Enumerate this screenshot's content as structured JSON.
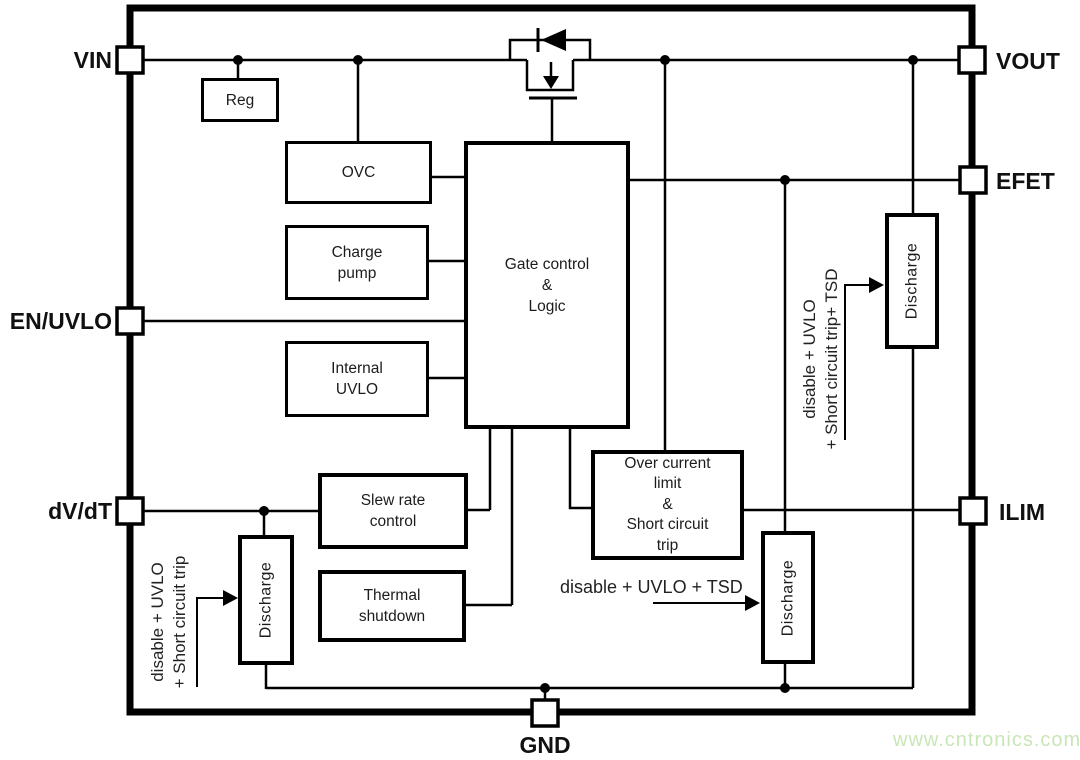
{
  "diagram": {
    "title": "Load switch functional block diagram",
    "pins": {
      "vin": "VIN",
      "en_uvlo": "EN/UVLO",
      "dvdt": "dV/dT",
      "vout": "VOUT",
      "efet": "EFET",
      "ilim": "ILIM",
      "gnd": "GND"
    },
    "blocks": {
      "reg": "Reg",
      "ovc": "OVC",
      "charge_pump": "Charge\npump",
      "internal_uvlo": "Internal\nUVLO",
      "gate_control": "Gate control\n&\nLogic",
      "slew_rate": "Slew rate\ncontrol",
      "thermal_shutdown": "Thermal\nshutdown",
      "over_current": "Over current\nlimit\n&\nShort circuit\ntrip",
      "discharge_top_right": "Discharge",
      "discharge_bottom_left": "Discharge",
      "discharge_bottom_right": "Discharge"
    },
    "annotations": {
      "left": "disable + UVLO\n+ Short circuit trip",
      "right": "disable + UVLO\n+ Short circuit trip+ TSD",
      "bottom": "disable + UVLO + TSD"
    },
    "watermark": "www.cntronics.com",
    "colors": {
      "line": "#000000",
      "background": "#ffffff",
      "watermark_green": "#c9e6b8"
    }
  }
}
